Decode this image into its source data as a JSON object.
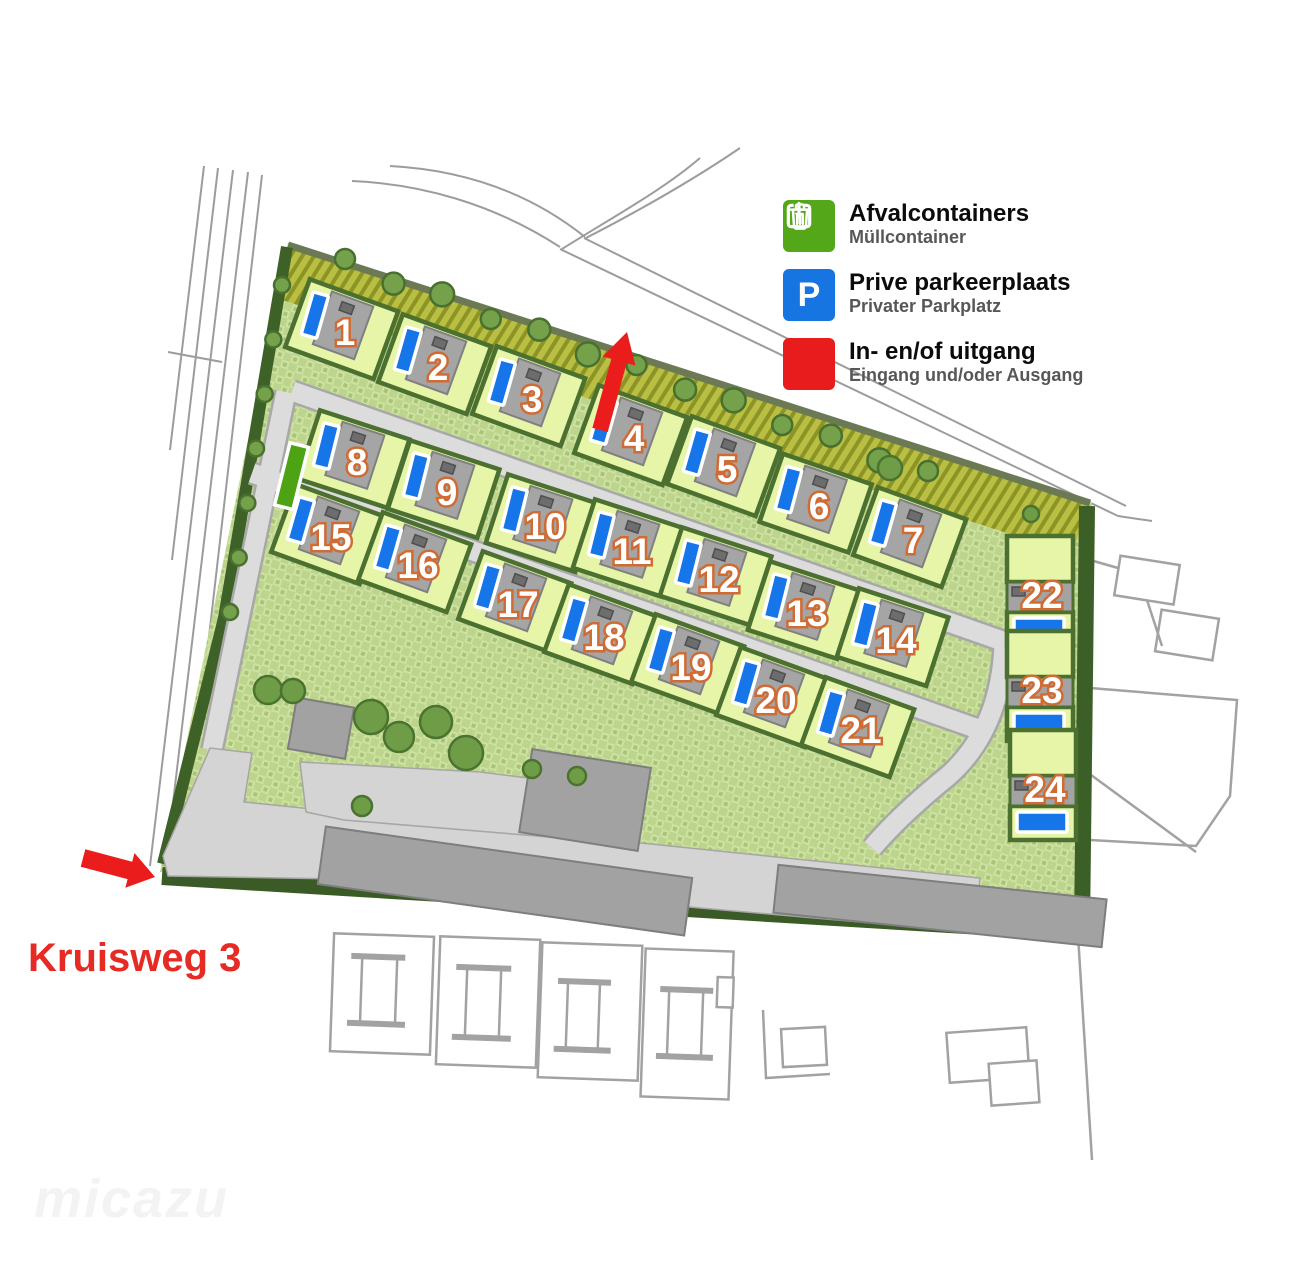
{
  "legend": {
    "items": [
      {
        "id": "afvalcontainers",
        "label": "Afvalcontainers",
        "sublabel": "Müllcontainer",
        "color": "#53a718",
        "icon": "trash-icon"
      },
      {
        "id": "prive-parkeerplaats",
        "label": "Prive parkeerplaats",
        "sublabel": "Privater Parkplatz",
        "color": "#1675e0",
        "icon": "parking-icon"
      },
      {
        "id": "in-en-of-uitgang",
        "label": "In- en/of uitgang",
        "sublabel": "Eingang und/oder Ausgang",
        "color": "#e81c1c",
        "icon": "entrance-exit-icon"
      }
    ]
  },
  "map": {
    "street_label": "Kruisweg 3",
    "watermark": "micazu",
    "colors": {
      "parking_blue": "#1675e8",
      "container_green": "#4da313",
      "arrow_red": "#ea1c1c",
      "plot_green": "#e6f5a7",
      "hedge_green": "#4c7030",
      "roof_gray": "#a5a5a5"
    },
    "plots": [
      {
        "n": 1,
        "x": 341,
        "y": 331,
        "angle": 20,
        "kind": "row"
      },
      {
        "n": 2,
        "x": 434,
        "y": 366,
        "angle": 20,
        "kind": "row"
      },
      {
        "n": 3,
        "x": 528,
        "y": 398,
        "angle": 20,
        "kind": "row"
      },
      {
        "n": 4,
        "x": 630,
        "y": 437,
        "angle": 20,
        "kind": "row"
      },
      {
        "n": 5,
        "x": 723,
        "y": 468,
        "angle": 20,
        "kind": "row"
      },
      {
        "n": 6,
        "x": 815,
        "y": 505,
        "angle": 19,
        "kind": "row"
      },
      {
        "n": 7,
        "x": 909,
        "y": 539,
        "angle": 20,
        "kind": "row"
      },
      {
        "n": 8,
        "x": 353,
        "y": 461,
        "angle": 18,
        "kind": "row"
      },
      {
        "n": 9,
        "x": 443,
        "y": 491,
        "angle": 18,
        "kind": "row"
      },
      {
        "n": 10,
        "x": 541,
        "y": 525,
        "angle": 18,
        "kind": "row"
      },
      {
        "n": 11,
        "x": 628,
        "y": 550,
        "angle": 18,
        "kind": "row"
      },
      {
        "n": 12,
        "x": 715,
        "y": 578,
        "angle": 18,
        "kind": "row"
      },
      {
        "n": 13,
        "x": 803,
        "y": 612,
        "angle": 18,
        "kind": "row"
      },
      {
        "n": 14,
        "x": 892,
        "y": 639,
        "angle": 18,
        "kind": "row"
      },
      {
        "n": 15,
        "x": 327,
        "y": 536,
        "angle": 20,
        "kind": "row"
      },
      {
        "n": 16,
        "x": 414,
        "y": 564,
        "angle": 20,
        "kind": "row"
      },
      {
        "n": 17,
        "x": 514,
        "y": 603,
        "angle": 20,
        "kind": "row"
      },
      {
        "n": 18,
        "x": 600,
        "y": 636,
        "angle": 20,
        "kind": "row"
      },
      {
        "n": 19,
        "x": 687,
        "y": 666,
        "angle": 20,
        "kind": "row"
      },
      {
        "n": 20,
        "x": 772,
        "y": 699,
        "angle": 20,
        "kind": "row"
      },
      {
        "n": 21,
        "x": 857,
        "y": 729,
        "angle": 20,
        "kind": "row"
      },
      {
        "n": 22,
        "x": 1040,
        "y": 596,
        "angle": 0,
        "kind": "stack"
      },
      {
        "n": 23,
        "x": 1040,
        "y": 691,
        "angle": 0,
        "kind": "stack"
      },
      {
        "n": 24,
        "x": 1043,
        "y": 790,
        "angle": 0,
        "kind": "stack"
      }
    ]
  }
}
